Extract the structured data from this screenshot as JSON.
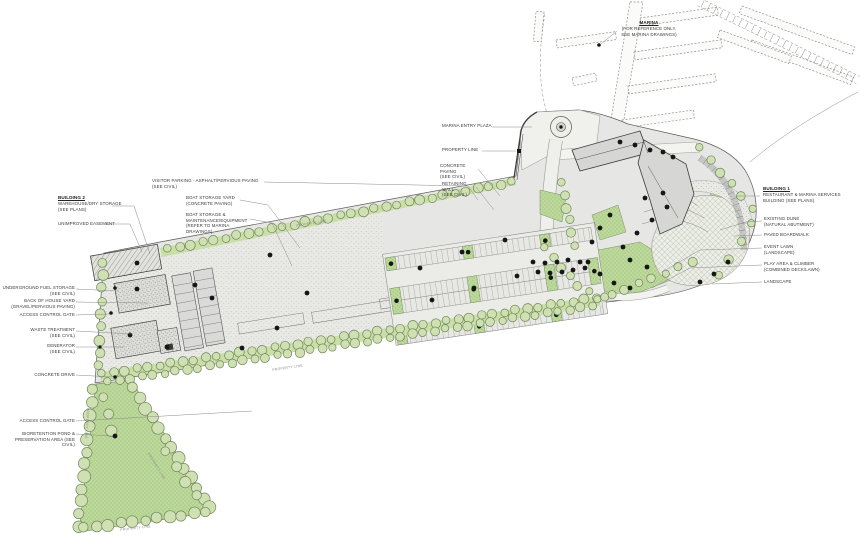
{
  "drawing": {
    "kind_note": "architectural landscape site plan with marina",
    "colors": {
      "paper": "#ffffff",
      "site_gray": "#e6e7e4",
      "paving_light": "#f0f0ed",
      "building_gray": "#d6d7d4",
      "landscape_green": "#bcd99b",
      "tree_green": "#cfe0b2",
      "tree_outline": "#71855c",
      "ink": "#3f3f3f",
      "palm_black": "#161616"
    }
  },
  "labels": {
    "marina": {
      "title": "MARINA",
      "lines": [
        "(FOR REFERENCE ONLY,",
        "SEE MARINA DRAWINGS)"
      ]
    },
    "building2": {
      "title": "BUILDING 2",
      "lines": [
        "WAREHOUSE/DRY STORAGE",
        "(SEE PLANS)"
      ]
    },
    "unimproved_easement": {
      "lines": [
        "UNIMPROVED EASEMENT"
      ]
    },
    "visitor_parking": {
      "lines": [
        "VISITOR PARKING - ASPHALT/PERVIOUS PAVING",
        "(SEE CIVIL)"
      ]
    },
    "boat_storage_yard": {
      "lines": [
        "BOAT STORAGE YARD",
        "(CONCRETE PAVING)"
      ]
    },
    "boat_maintenance": {
      "lines": [
        "BOAT STORAGE &",
        "MAINTENANCE/EQUIPMENT",
        "(REFER TO MARINA DRAWINGS)"
      ]
    },
    "marina_entry_plaza": {
      "lines": [
        "MARINA ENTRY PLAZA"
      ]
    },
    "property_line_top": {
      "lines": [
        "PROPERTY LINE"
      ]
    },
    "concrete_paving": {
      "lines": [
        "CONCRETE PAVING",
        "(SEE CIVIL)"
      ]
    },
    "retaining_wall": {
      "lines": [
        "RETAINING WALL",
        "(SEE CIVIL)"
      ]
    },
    "building1": {
      "title": "BUILDING 1",
      "lines": [
        "RESTAURANT & MARINA SERVICES",
        "BUILDING (SEE PLANS)"
      ]
    },
    "existing_dune": {
      "lines": [
        "EXISTING DUNE",
        "(NATURAL ABUTMENT)"
      ]
    },
    "paved_boardwalk": {
      "lines": [
        "PAVED BOARDWALK"
      ]
    },
    "event_lawn": {
      "lines": [
        "EVENT LAWN",
        "(LANDSCAPE)"
      ]
    },
    "play_area": {
      "lines": [
        "PLAY AREA & CLIMBER",
        "(COMBINED DECK/LAWN)"
      ]
    },
    "landscape": {
      "lines": [
        "LANDSCAPE"
      ]
    },
    "fuel_storage": {
      "lines": [
        "UNDERGROUND FUEL STORAGE",
        "(SEE CIVIL)"
      ]
    },
    "back_of_house": {
      "lines": [
        "BACK OF HOUSE YARD",
        "(GRAVEL/PERVIOUS PAVING)"
      ]
    },
    "access_gate_1": {
      "lines": [
        "ACCESS CONTROL GATE"
      ]
    },
    "waste_treatment": {
      "lines": [
        "WASTE TREATMENT",
        "(SEE CIVIL)"
      ]
    },
    "generator": {
      "lines": [
        "GENERATOR",
        "(SEE CIVIL)"
      ]
    },
    "concrete_drive": {
      "lines": [
        "CONCRETE DRIVE"
      ]
    },
    "access_gate_2": {
      "lines": [
        "ACCESS CONTROL GATE"
      ]
    },
    "bioretention": {
      "lines": [
        "BIORETENTION POND &",
        "PRESERVATION AREA (SEE CIVIL)"
      ]
    },
    "property_line_edge": "PROPERTY LINE"
  }
}
